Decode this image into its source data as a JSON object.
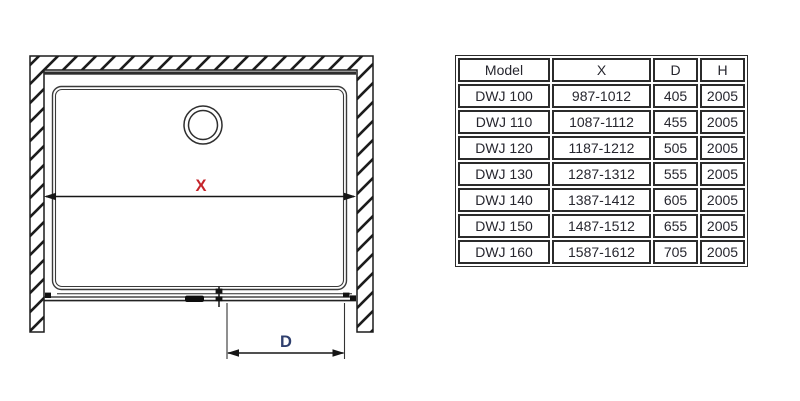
{
  "diagram": {
    "x_label": "X",
    "d_label": "D",
    "x_color": "#c5242b",
    "d_color": "#2f3f6e",
    "description_parts": {
      "walls": "hatched wall section (left, top, right)",
      "tray": "shower tray rounded rectangle",
      "drain": "drain circle",
      "door": "sliding door track with rollers and handle"
    }
  },
  "colors": {
    "line": "#1c1c1c",
    "accent_red": "#c5242b",
    "accent_navy": "#2f3f6e",
    "text": "#26262e",
    "table_border": "#2b2b2b",
    "background": "#ffffff"
  },
  "table": {
    "headers": {
      "model": "Model",
      "x": "X",
      "d": "D",
      "h": "H"
    },
    "rows": [
      {
        "model": "DWJ 100",
        "x": "987-1012",
        "d": "405",
        "h": "2005"
      },
      {
        "model": "DWJ 110",
        "x": "1087-1112",
        "d": "455",
        "h": "2005"
      },
      {
        "model": "DWJ 120",
        "x": "1187-1212",
        "d": "505",
        "h": "2005"
      },
      {
        "model": "DWJ 130",
        "x": "1287-1312",
        "d": "555",
        "h": "2005"
      },
      {
        "model": "DWJ 140",
        "x": "1387-1412",
        "d": "605",
        "h": "2005"
      },
      {
        "model": "DWJ 150",
        "x": "1487-1512",
        "d": "655",
        "h": "2005"
      },
      {
        "model": "DWJ 160",
        "x": "1587-1612",
        "d": "705",
        "h": "2005"
      }
    ]
  }
}
